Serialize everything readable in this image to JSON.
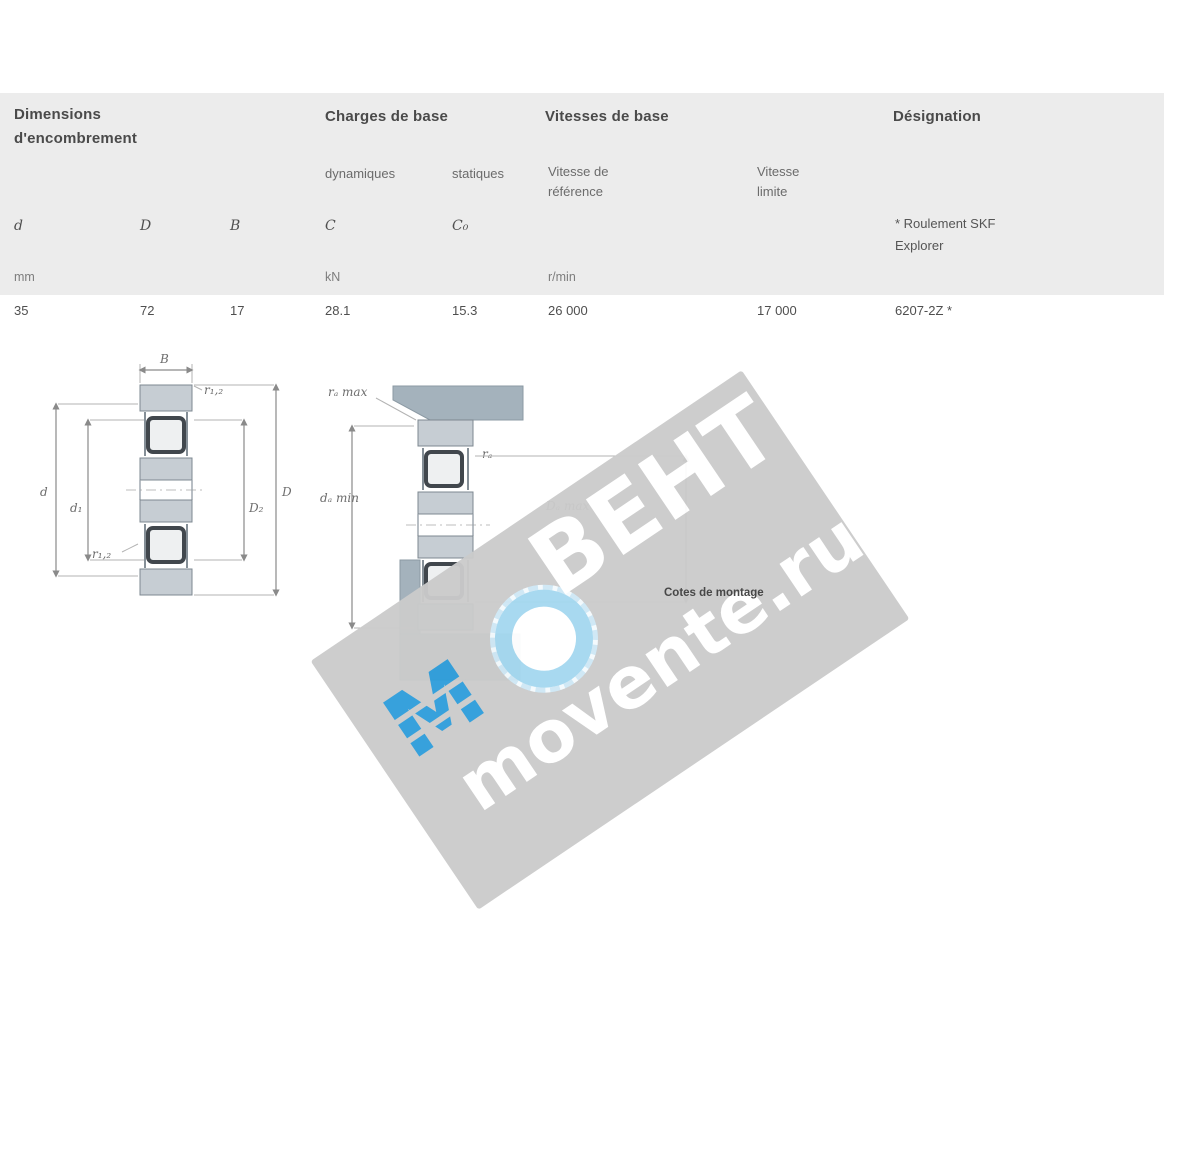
{
  "table": {
    "groups": {
      "dimensions": {
        "line1": "Dimensions",
        "line2": "d'encombrement"
      },
      "loads": {
        "title": "Charges de base",
        "dynamic": "dynamiques",
        "static": "statiques"
      },
      "speeds": {
        "title": "Vitesses de base",
        "ref1": "Vitesse de",
        "ref2": "référence",
        "lim1": "Vitesse",
        "lim2": "limite"
      },
      "designation": {
        "title": "Désignation",
        "note1": "* Roulement SKF",
        "note2": "Explorer"
      }
    },
    "symbols": {
      "d": "d",
      "D": "D",
      "B": "B",
      "C": "C",
      "C0": "C₀"
    },
    "units": {
      "mm": "mm",
      "kn": "kN",
      "rmin": "r/min"
    },
    "row": {
      "d": "35",
      "D": "72",
      "B": "17",
      "C": "28.1",
      "C0": "15.3",
      "speed_ref": "26 000",
      "speed_lim": "17 000",
      "designation": "6207-2Z *"
    }
  },
  "figures": {
    "boundary": {
      "B": "B",
      "r12_top": "r₁,₂",
      "d": "d",
      "d1": "d₁",
      "D2": "D₂",
      "D": "D",
      "r12_bottom": "r₁,₂"
    },
    "mounting": {
      "ra": "rₐ max",
      "ra_small": "rₐ",
      "da": "dₐ min",
      "Da": "Dₐ max",
      "caption": "Cotes de montage"
    }
  },
  "watermark": {
    "logo_letter": "M",
    "brand": "ВЕНТ",
    "site": "movente.ru",
    "colors": {
      "band": "#cbcbcb",
      "blue": "#2f9edb",
      "pale_blue": "#a5d8f0",
      "text": "#ffffff"
    }
  }
}
